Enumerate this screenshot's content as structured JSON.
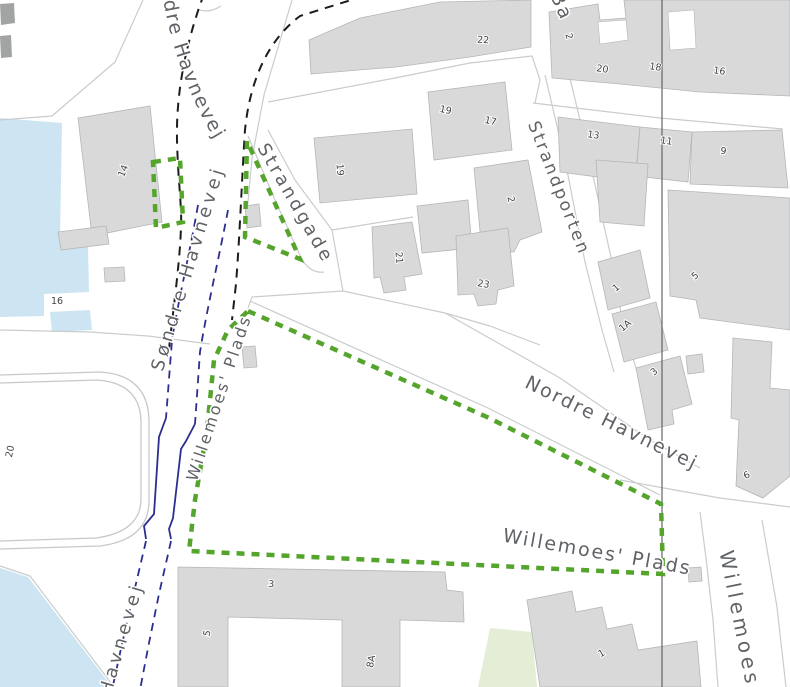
{
  "title": "Map view",
  "canvas": {
    "width": 790,
    "height": 687,
    "background": "#ffffff"
  },
  "colors": {
    "water": "#cde5f3",
    "building_fill": "#d9d9d9",
    "building_stroke": "#b5b6b8",
    "dark_structure": "#a2a4a4",
    "road_line": "#c9ccce",
    "parking_line": "#c6c9cb",
    "park": "#e4eed6",
    "boundary_line": "#646464",
    "green_dashed": "#55a52d",
    "black_dashed": "#1c1c1c",
    "blue_dashed": "#2b2e8f",
    "street_label": "#5f6266",
    "number_label": "#3f4245",
    "halo": "#ffffff"
  },
  "layers": {
    "water": [
      "M0,118 L62,123 L60,240 L88,244 L89,292 L44,294 L44,316 L0,317 Z",
      "M50,312 L90,310 L92,330 L52,332 Z",
      "M0,568 L28,577 L112,687 L0,687 Z"
    ],
    "park": [
      "M490,628 L532,632 L537,687 L478,687 Z"
    ],
    "parking_outline": [
      "M0,375 L100,372 Q148,375 149,420 L149,502 Q148,540 100,546 L0,549",
      "M0,383 L97,380 Q140,383 141,421 L141,500 Q140,532 96,538 L0,541"
    ],
    "road_lines": [
      "M143,0 L115,62 L52,116 L0,120",
      "M292,0 L264,95 L252,158 L247,213",
      "M268,102 L395,78 L470,63 L532,56 L540,80 L535,103",
      "M533,103 L660,118 L783,129",
      "M413,217 L332,230 L341,280 L343,291 L445,313 L490,326 L540,345",
      "M343,291 L252,297 L248,308",
      "M250,301 L488,408 L660,495",
      "M445,313 L560,378 L650,440 L700,468",
      "M620,480 L675,490 L720,498 L790,507",
      "M700,512 L706,558 L713,620 L718,687",
      "M762,520 L777,607 L786,687",
      "M545,75 L565,160 L585,262 L602,330 L614,372",
      "M568,70 L590,162 L612,262 L624,330 L636,368",
      "M248,136 L275,200 L302,260 Q312,274 324,272",
      "M268,130 L295,180 L332,230",
      "M0,330 L90,332 L148,336 L210,344",
      "M0,566 L30,576 L114,687",
      "M197,9 Q209,14 221,6"
    ],
    "buildings": [
      "M78,118 L150,106 L162,222 L92,236 Z",
      "M58,232 L106,226 L109,244 L61,250 Z",
      "M104,268 L124,267 L125,281 L105,282 Z",
      "M309,40 L360,18 L440,2 L531,0 L531,47 L470,57 L396,67 L311,74 Z",
      "M549,12 L598,4 L600,20 L626,18 L624,0 L790,0 L790,96 L700,92 L620,84 L552,78 Z",
      "M558,117 L640,127 L636,172 L600,167 L598,177 L560,172 Z",
      "M640,127 L692,132 L688,182 L636,176 Z",
      "M692,132 L782,130 L788,188 L690,184 Z",
      "M596,160 L648,164 L644,226 L600,222 Z",
      "M314,138 L412,129 L417,194 L320,203 Z",
      "M428,92 L505,82 L512,150 L434,160 Z",
      "M474,168 L528,160 L542,232 L520,240 L514,252 L482,252 Z",
      "M372,227 L412,222 L422,274 L404,277 L406,290 L384,293 L380,277 L374,278 Z",
      "M417,206 L468,200 L472,248 L422,253 Z",
      "M456,236 L508,228 L514,286 L498,290 L496,304 L478,306 L474,294 L458,295 Z",
      "M245,206 L259,204 L261,226 L247,228 Z",
      "M242,347 L255,346 L257,367 L244,368 Z",
      "M598,262 L640,250 L650,298 L608,310 Z",
      "M612,314 L656,302 L668,350 L624,362 Z",
      "M636,368 L680,356 L692,404 L672,410 L674,424 L648,430 Z",
      "M686,356 L702,354 L704,372 L688,374 Z",
      "M668,190 L790,198 L790,330 L700,318 L696,300 L670,296 Z",
      "M733,338 L772,342 L770,388 L790,390 L790,476 L763,498 L736,486 L739,420 L731,418 Z",
      "M178,567 L445,572 L447,590 L463,592 L464,622 L400,620 L400,687 L342,687 L342,620 L228,617 L228,687 L178,687 Z",
      "M527,600 L572,591 L576,612 L602,607 L607,629 L632,624 L638,650 L697,641 L701,687 L540,687 Z",
      "M688,568 L701,567 L702,581 L689,582 Z"
    ],
    "building_gaps": [
      "M598,22 L626,20 L628,40 L600,44 Z",
      "M668,12 L694,10 L696,48 L670,50 Z"
    ],
    "dark_structures": [
      "M0,4 L14,3 L15,23 L1,25 Z",
      "M0,36 L11,35 L12,57 L1,58 Z"
    ],
    "boundary_lines": [
      "M662,0 L662,687"
    ],
    "green_dashed": [
      "M153,162 L180,158 L183,222 L156,228 Z",
      "M247,141 L245,237 L300,259 Z",
      "M248,311 L487,417 L661,504 L663,574 L189,551 L195,500 L207,430 L214,360 L228,330 Z"
    ],
    "black_dashed": [
      "M204,-6 C186,42 176,92 177,140 C178,182 182,206 181,226 C180,262 174,302 168,358",
      "M364,-4 L300,16 C268,40 250,80 245,130 C242,176 240,232 236,284 L232,320"
    ],
    "blue_dashed": [
      "M198,205 C190,252 178,302 172,340 L166,418",
      "M228,210 C219,258 207,308 200,352 L195,424",
      "M146,541 L134,592 L122,644 L112,690",
      "M171,541 L159,594 L148,648 L140,690"
    ],
    "blue_solid": [
      "M166,418 L159,437 L154,514 L144,526 L146,539",
      "M195,424 L186,441 L181,449 L173,518 L169,529 L171,539"
    ]
  },
  "street_labels": [
    {
      "text": "Nordre Havnevej",
      "d": "M158,-40 Q168,70 224,154",
      "size": 19,
      "ls": 2
    },
    {
      "text": "Søndre Havnevej",
      "d": "M162,374 L231,146",
      "size": 18,
      "ls": 4
    },
    {
      "text": "Strandgade",
      "d": "M256,146 L326,268",
      "size": 18,
      "ls": 3
    },
    {
      "text": "Strandporten",
      "d": "M527,122 L586,272",
      "size": 17,
      "ls": 2.5
    },
    {
      "text": "Ba",
      "d": "M549,-6 L572,44",
      "size": 19,
      "ls": 2
    },
    {
      "text": "Nordre Havnevej",
      "d": "M522,386 L702,474",
      "size": 19,
      "ls": 2
    },
    {
      "text": "Willemoes' Plads",
      "d": "M500,541 L697,576",
      "size": 19,
      "ls": 2
    },
    {
      "text": "Willemoes' Plads",
      "d": "M196,484 L256,303",
      "size": 16,
      "ls": 2.5
    },
    {
      "text": "Havnevej",
      "d": "M110,698 L147,572",
      "size": 18,
      "ls": 4
    },
    {
      "text": "Willemoes",
      "d": "M719,550 L749,700",
      "size": 20,
      "ls": 4
    }
  ],
  "number_labels": [
    {
      "text": "14",
      "x": 126,
      "y": 172,
      "rot": -68
    },
    {
      "text": "16",
      "x": 57,
      "y": 304,
      "rot": 0
    },
    {
      "text": "20",
      "x": 13,
      "y": 452,
      "rot": -78
    },
    {
      "text": "22",
      "x": 483,
      "y": 43,
      "rot": 3
    },
    {
      "text": "2",
      "x": 566,
      "y": 37,
      "rot": 75
    },
    {
      "text": "20",
      "x": 602,
      "y": 72,
      "rot": 8
    },
    {
      "text": "18",
      "x": 655,
      "y": 70,
      "rot": 8
    },
    {
      "text": "16",
      "x": 719,
      "y": 74,
      "rot": 8
    },
    {
      "text": "13",
      "x": 593,
      "y": 138,
      "rot": 8
    },
    {
      "text": "11",
      "x": 666,
      "y": 144,
      "rot": 8
    },
    {
      "text": "9",
      "x": 723,
      "y": 154,
      "rot": 8
    },
    {
      "text": "19",
      "x": 337,
      "y": 170,
      "rot": 85
    },
    {
      "text": "19",
      "x": 445,
      "y": 113,
      "rot": 12
    },
    {
      "text": "17",
      "x": 490,
      "y": 124,
      "rot": 12
    },
    {
      "text": "2",
      "x": 508,
      "y": 200,
      "rot": 78
    },
    {
      "text": "21",
      "x": 396,
      "y": 258,
      "rot": 85
    },
    {
      "text": "23",
      "x": 483,
      "y": 287,
      "rot": 10
    },
    {
      "text": "1",
      "x": 618,
      "y": 290,
      "rot": -40
    },
    {
      "text": "1A",
      "x": 627,
      "y": 328,
      "rot": -40
    },
    {
      "text": "3",
      "x": 656,
      "y": 374,
      "rot": -40
    },
    {
      "text": "5",
      "x": 697,
      "y": 278,
      "rot": -40
    },
    {
      "text": "6",
      "x": 748,
      "y": 478,
      "rot": -25
    },
    {
      "text": "3",
      "x": 271,
      "y": 587,
      "rot": 5
    },
    {
      "text": "5",
      "x": 210,
      "y": 634,
      "rot": -75
    },
    {
      "text": "8A",
      "x": 374,
      "y": 662,
      "rot": -80
    },
    {
      "text": "1",
      "x": 603,
      "y": 656,
      "rot": -30
    }
  ]
}
